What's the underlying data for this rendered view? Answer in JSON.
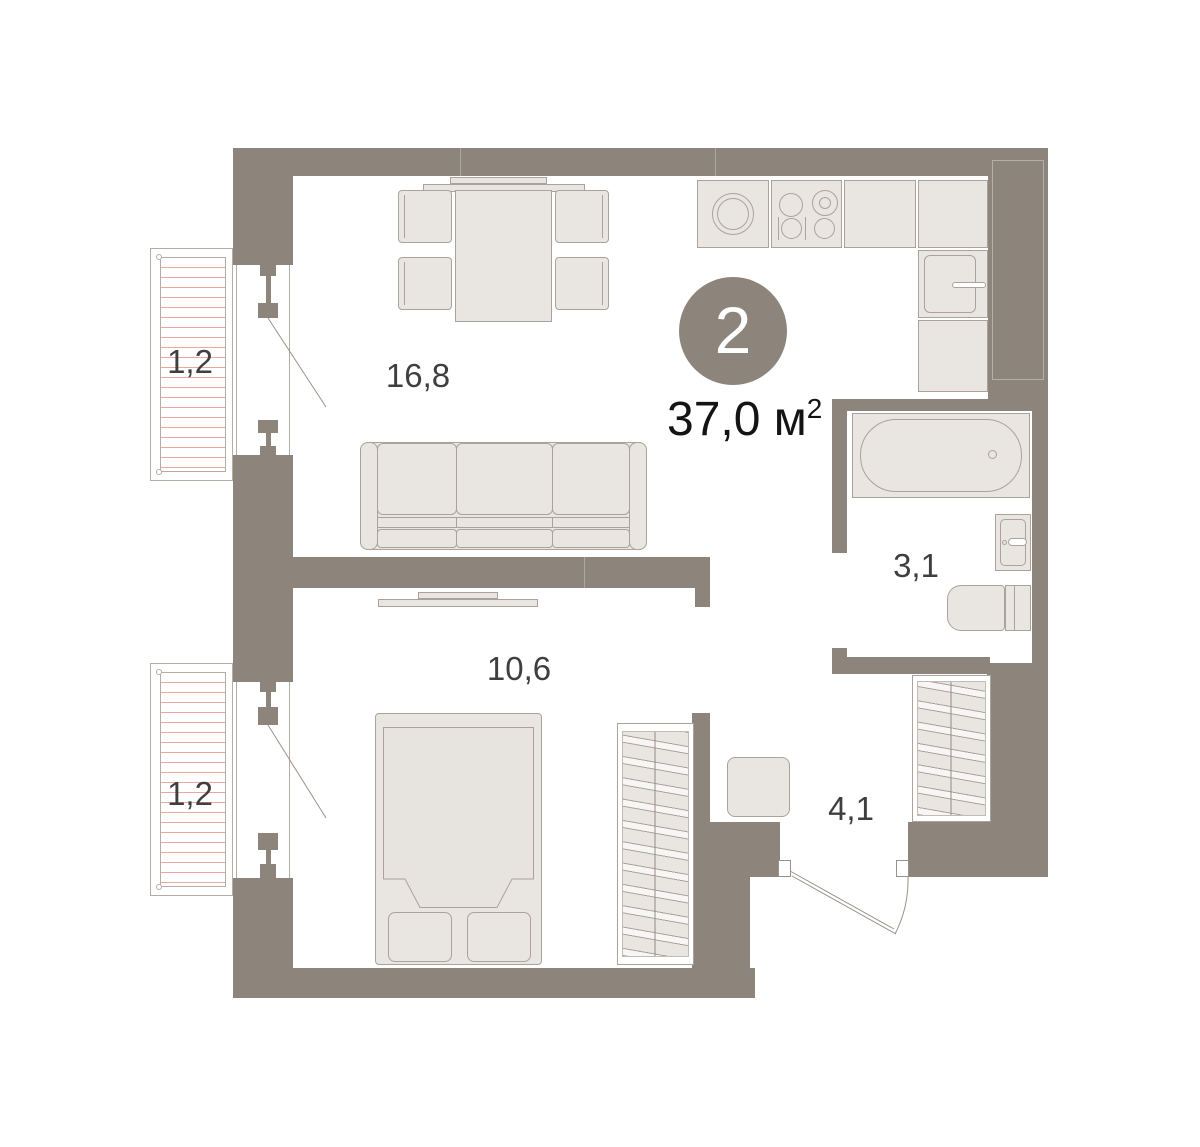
{
  "plan": {
    "badge": {
      "rooms_count": "2"
    },
    "total_area": {
      "value": "37,0",
      "unit": "м",
      "superscript": "2"
    },
    "labels": {
      "living": "16,8",
      "bedroom": "10,6",
      "bathroom": "3,1",
      "hallway": "4,1",
      "balcony_top": "1,2",
      "balcony_bottom": "1,2"
    },
    "colors": {
      "wall": "#8D857C",
      "furniture_fill": "#E9E5E1",
      "furniture_border": "#ABA39B",
      "balcony_hatch": "#EBA89E",
      "room_label": "#3F3F3F",
      "total_label": "#141414",
      "badge_fill": "#8D857C",
      "badge_text": "#FFFFFF"
    }
  }
}
